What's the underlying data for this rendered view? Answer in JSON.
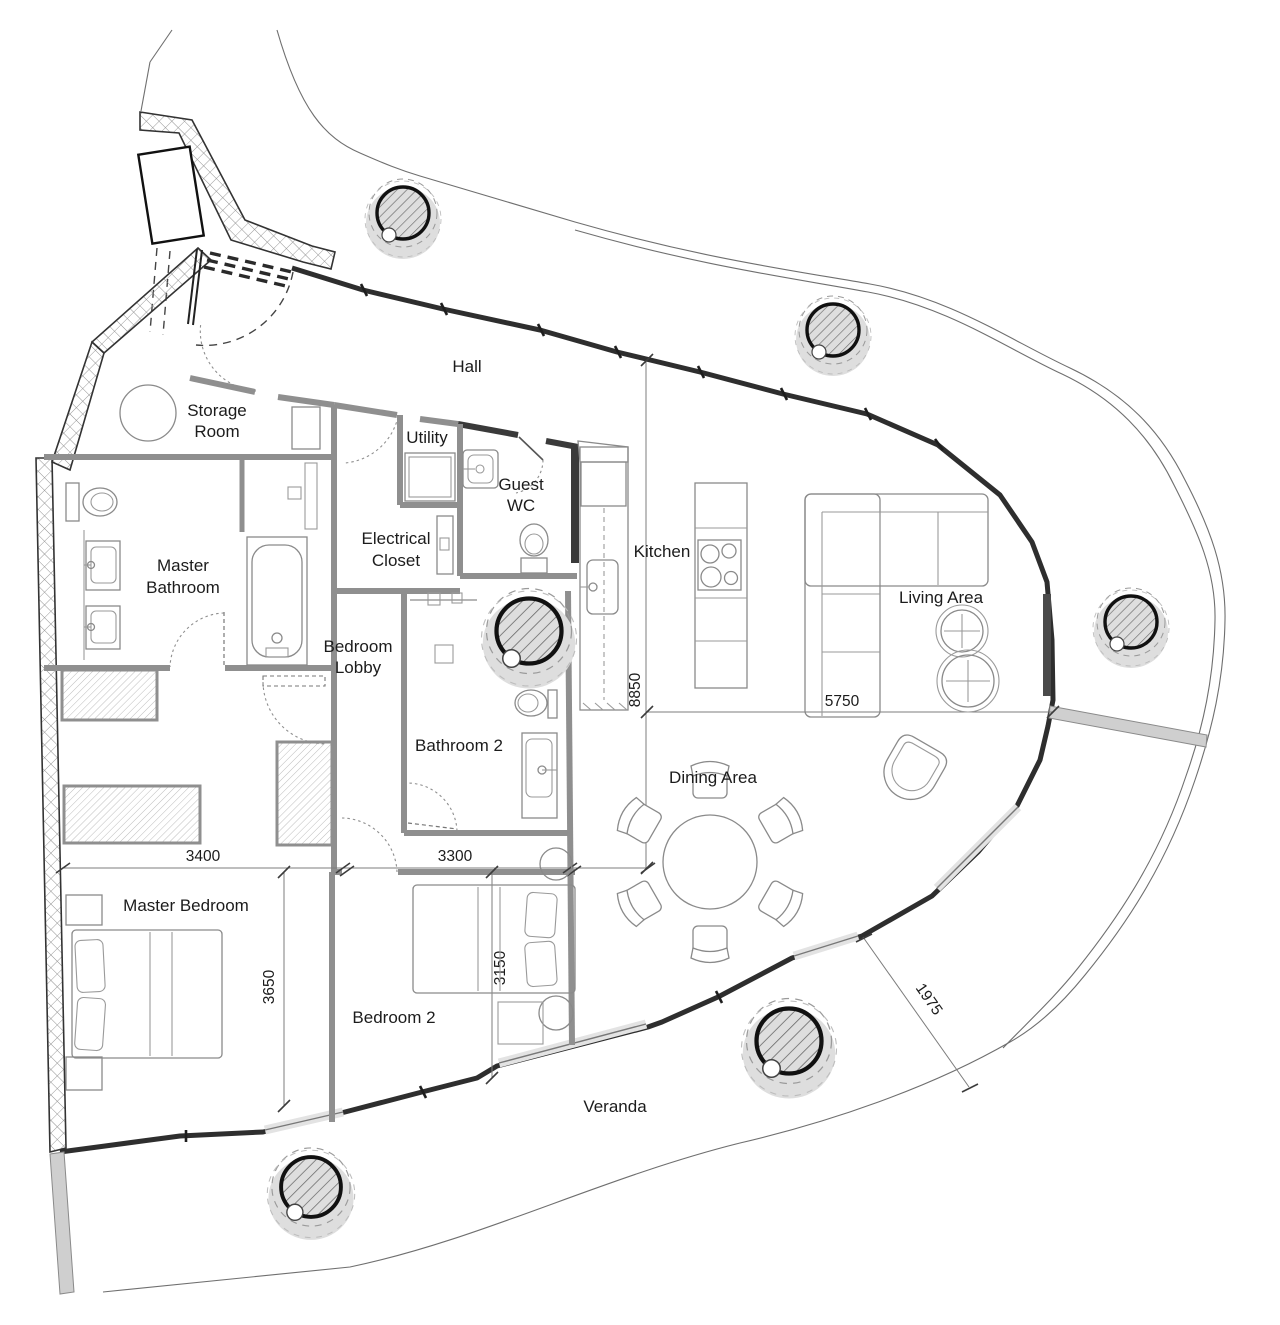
{
  "diagram": {
    "type": "architectural-floor-plan",
    "background_color": "#ffffff",
    "exterior_wall_color": "#2e2e2e",
    "interior_wall_color": "#8f8f8f",
    "rooms": {
      "hall": {
        "label": "Hall"
      },
      "storage_room": {
        "label_line1": "Storage",
        "label_line2": "Room"
      },
      "utility": {
        "label": "Utility"
      },
      "guest_wc": {
        "label_line1": "Guest",
        "label_line2": "WC"
      },
      "kitchen": {
        "label": "Kitchen"
      },
      "living_area": {
        "label": "Living Area"
      },
      "master_bathroom": {
        "label_line1": "Master",
        "label_line2": "Bathroom"
      },
      "electrical_closet": {
        "label_line1": "Electrical",
        "label_line2": "Closet"
      },
      "bedroom_lobby": {
        "label_line1": "Bedroom",
        "label_line2": "Lobby"
      },
      "bathroom_2": {
        "label": "Bathroom 2"
      },
      "dining_area": {
        "label": "Dining Area"
      },
      "master_bedroom": {
        "label": "Master Bedroom"
      },
      "bedroom_2": {
        "label": "Bedroom 2"
      },
      "veranda": {
        "label": "Veranda"
      }
    },
    "dimensions_mm": {
      "master_bedroom_width": "3400",
      "bedroom_2_width": "3300",
      "master_bedroom_depth": "3650",
      "bedroom_2_depth": "3150",
      "open_area_depth": "8850",
      "living_area_width": "5750",
      "veranda_width": "1975"
    }
  }
}
